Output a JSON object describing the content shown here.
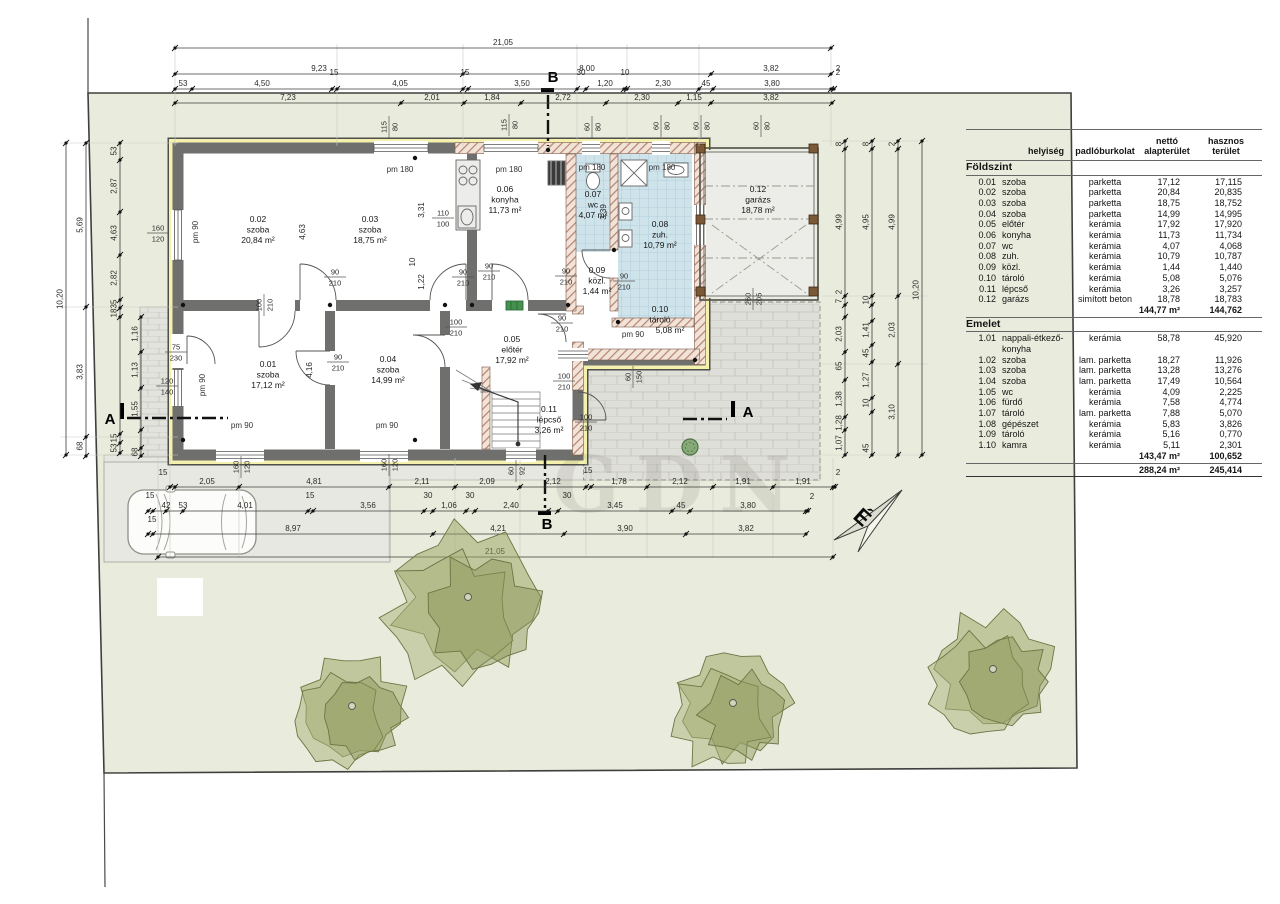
{
  "page": {
    "watermark": "GDN",
    "background": "#ffffff"
  },
  "colors": {
    "site_green": "#e9ecdc",
    "wall_gray": "#6f6f6d",
    "insulation_yellow": "#f4f1ae",
    "wall_hatch": "#b08068",
    "tile_blue": "#cfe3eb",
    "paving_gray": "#e7e7e2",
    "tree_olive": "#97a15e"
  },
  "north": {
    "label": "É"
  },
  "section_markers": {
    "a": "A",
    "b": "B"
  },
  "rooms": [
    {
      "num": "0.01",
      "name": "szoba",
      "area": "17,12 m²"
    },
    {
      "num": "0.02",
      "name": "szoba",
      "area": "20,84 m²"
    },
    {
      "num": "0.03",
      "name": "szoba",
      "area": "18,75 m²"
    },
    {
      "num": "0.04",
      "name": "szoba",
      "area": "14,99 m²"
    },
    {
      "num": "0.05",
      "name": "előtér",
      "area": "17,92 m²"
    },
    {
      "num": "0.06",
      "name": "konyha",
      "area": "11,73 m²"
    },
    {
      "num": "0.07",
      "name": "wc",
      "area": "4,07 m²"
    },
    {
      "num": "0.08",
      "name": "zuh.",
      "area": "10,79 m²"
    },
    {
      "num": "0.09",
      "name": "közl.",
      "area": "1,44 m²"
    },
    {
      "num": "0.10",
      "name": "tároló",
      "area": "5,08 m²"
    },
    {
      "num": "0.11",
      "name": "lépcső",
      "area": "3,26 m²"
    },
    {
      "num": "0.12",
      "name": "garázs",
      "area": "18,78 m²"
    }
  ],
  "window_labels": [
    "pm 90",
    "pm 90",
    "pm 180",
    "pm 180",
    "pm 180",
    "pm 180",
    "pm 90",
    "pm 90",
    "pm 90"
  ],
  "opening_sizes": [
    [
      "115",
      "80"
    ],
    [
      "115",
      "80"
    ],
    [
      "60",
      "80"
    ],
    [
      "60",
      "80"
    ],
    [
      "60",
      "80"
    ],
    [
      "60",
      "80"
    ],
    [
      "160",
      "120"
    ],
    [
      "75",
      "230"
    ],
    [
      "120",
      "140"
    ],
    [
      "160",
      "120"
    ],
    [
      "160",
      "120"
    ],
    [
      "60",
      "92"
    ],
    [
      "110",
      "100"
    ],
    [
      "90",
      "210"
    ],
    [
      "100",
      "210"
    ],
    [
      "90",
      "210"
    ],
    [
      "90",
      "210"
    ],
    [
      "90",
      "210"
    ],
    [
      "90",
      "210"
    ],
    [
      "90",
      "210"
    ],
    [
      "100",
      "210"
    ],
    [
      "90",
      "210"
    ],
    [
      "100",
      "210"
    ],
    [
      "100",
      "210"
    ],
    [
      "60",
      "150"
    ],
    [
      "260",
      "205"
    ]
  ],
  "interior_dims": [
    "4,63",
    "3,31",
    "10",
    "1,22",
    "4,16",
    "3,39"
  ],
  "dims": {
    "top": [
      [
        "21,05"
      ],
      [
        "9,23",
        "8,00",
        "3,82",
        "2"
      ],
      [
        "53",
        "4,50",
        "15",
        "4,05",
        "15",
        "3,50",
        "30",
        "1,20",
        "10",
        "2,30",
        "45",
        "3,80",
        "2"
      ],
      [
        "7,23",
        "2,01",
        "1,84",
        "2,72",
        "2,30",
        "1,15",
        "3,82"
      ]
    ],
    "bottom": [
      [
        "15",
        "2,05",
        "4,81",
        "2,11",
        "2,09",
        "2,12",
        "15",
        "1,78",
        "2,12",
        "1,91",
        "1,91",
        "2"
      ],
      [
        "15",
        "42",
        "53",
        "4,01",
        "15",
        "3,56",
        "30",
        "1,06",
        "30",
        "2,40",
        "30",
        "3,45",
        "45",
        "3,80",
        "2"
      ],
      [
        "15",
        "8,97",
        "4,21",
        "3,90",
        "3,82"
      ],
      [
        "21,05"
      ]
    ],
    "left": [
      [
        "10,20"
      ],
      [
        "5,69",
        "3,83",
        "68"
      ],
      [
        "53",
        "2,87",
        "4,63",
        "2,82",
        "35",
        "18",
        "15",
        "53"
      ],
      [
        "1,16",
        "1,13",
        "1,55",
        "68"
      ]
    ],
    "right": [
      [
        "8",
        "4,99",
        "2",
        "7",
        "2,03",
        "65",
        "1,38",
        "1,28",
        "1,07"
      ],
      [
        "8",
        "4,95",
        "10",
        "1,41",
        "45",
        "1,27",
        "10",
        "45"
      ],
      [
        "2",
        "4,99",
        "2,03",
        "3,10"
      ],
      [
        "10,20"
      ]
    ]
  },
  "table": {
    "headers": [
      "helyiség",
      "padlóburkolat",
      "nettó\nalapterület",
      "hasznos\nterület"
    ],
    "sections": [
      {
        "title": "Földszint",
        "rows": [
          [
            "0.01",
            "szoba",
            "parketta",
            "17,12",
            "17,115"
          ],
          [
            "0.02",
            "szoba",
            "parketta",
            "20,84",
            "20,835"
          ],
          [
            "0.03",
            "szoba",
            "parketta",
            "18,75",
            "18,752"
          ],
          [
            "0.04",
            "szoba",
            "parketta",
            "14,99",
            "14,995"
          ],
          [
            "0.05",
            "előtér",
            "kerámia",
            "17,92",
            "17,920"
          ],
          [
            "0.06",
            "konyha",
            "kerámia",
            "11,73",
            "11,734"
          ],
          [
            "0.07",
            "wc",
            "kerámia",
            "4,07",
            "4,068"
          ],
          [
            "0.08",
            "zuh.",
            "kerámia",
            "10,79",
            "10,787"
          ],
          [
            "0.09",
            "közl.",
            "kerámia",
            "1,44",
            "1,440"
          ],
          [
            "0.10",
            "tároló",
            "kerámia",
            "5,08",
            "5,076"
          ],
          [
            "0.11",
            "lépcső",
            "kerámia",
            "3,26",
            "3,257"
          ],
          [
            "0.12",
            "garázs",
            "simított beton",
            "18,78",
            "18,783"
          ]
        ],
        "subtotal": [
          "144,77 m²",
          "144,762"
        ]
      },
      {
        "title": "Emelet",
        "rows": [
          [
            "1.01",
            "nappali-étkező-konyha",
            "kerámia",
            "58,78",
            "45,920"
          ],
          [
            "1.02",
            "szoba",
            "lam. parketta",
            "18,27",
            "11,926"
          ],
          [
            "1.03",
            "szoba",
            "lam. parketta",
            "13,28",
            "13,276"
          ],
          [
            "1.04",
            "szoba",
            "lam. parketta",
            "17,49",
            "10,564"
          ],
          [
            "1.05",
            "wc",
            "kerámia",
            "4,09",
            "2,225"
          ],
          [
            "1.06",
            "fürdő",
            "kerámia",
            "7,58",
            "4,774"
          ],
          [
            "1.07",
            "tároló",
            "lam. parketta",
            "7,88",
            "5,070"
          ],
          [
            "1.08",
            "gépészet",
            "kerámia",
            "5,83",
            "3,826"
          ],
          [
            "1.09",
            "tároló",
            "kerámia",
            "5,16",
            "0,770"
          ],
          [
            "1.10",
            "kamra",
            "kerámia",
            "5,11",
            "2,301"
          ]
        ],
        "subtotal": [
          "143,47 m²",
          "100,652"
        ]
      }
    ],
    "grand_total": [
      "288,24 m²",
      "245,414"
    ]
  }
}
